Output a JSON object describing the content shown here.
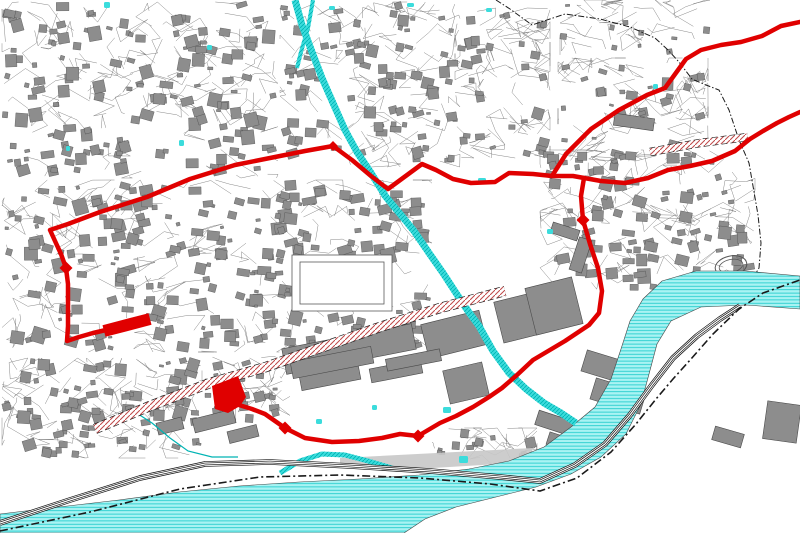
{
  "map": {
    "viewport": {
      "width": 800,
      "height": 533,
      "background": "#ffffff"
    },
    "colors": {
      "route_red": "#e00000",
      "water_fill": "#a9f3f3",
      "water_stripe": "#17c9c9",
      "stream_fill": "#3bdcdc",
      "stream_edge": "#00b4b4",
      "building_fill": "#8d8d8d",
      "building_stroke": "#4a4a4a",
      "parcel_line": "#737373",
      "railway_black": "#111111",
      "boundary_black": "#1a1a1a",
      "hatch_red": "#c04848",
      "station_gray": "#c8c8c8"
    },
    "route": {
      "width": 4.5,
      "main": [
        [
          800,
          22
        ],
        [
          781,
          26
        ],
        [
          762,
          36
        ],
        [
          741,
          42
        ],
        [
          721,
          45
        ],
        [
          701,
          50
        ],
        [
          686,
          59
        ],
        [
          665,
          88
        ],
        [
          647,
          95
        ],
        [
          619,
          110
        ],
        [
          591,
          129
        ],
        [
          566,
          154
        ],
        [
          552,
          176
        ],
        [
          533,
          174
        ],
        [
          509,
          173
        ],
        [
          495,
          182
        ],
        [
          471,
          183
        ],
        [
          453,
          179
        ],
        [
          436,
          170
        ],
        [
          422,
          164
        ],
        [
          388,
          189
        ],
        [
          371,
          176
        ],
        [
          352,
          160
        ],
        [
          333,
          146
        ],
        [
          305,
          151
        ],
        [
          275,
          157
        ],
        [
          235,
          165
        ],
        [
          190,
          179
        ],
        [
          147,
          197
        ],
        [
          100,
          212
        ],
        [
          68,
          224
        ],
        [
          50,
          230
        ],
        [
          55,
          241
        ],
        [
          61,
          254
        ],
        [
          66,
          268
        ],
        [
          68,
          284
        ],
        [
          68,
          306
        ],
        [
          68,
          326
        ],
        [
          67,
          341
        ],
        [
          79,
          337
        ],
        [
          93,
          333
        ],
        [
          106,
          330
        ]
      ],
      "branch_northeast": [
        [
          552,
          176
        ],
        [
          573,
          176
        ],
        [
          601,
          181
        ],
        [
          625,
          183
        ],
        [
          648,
          178
        ],
        [
          668,
          170
        ],
        [
          690,
          166
        ],
        [
          712,
          161
        ],
        [
          735,
          151
        ],
        [
          750,
          139
        ],
        [
          763,
          131
        ],
        [
          777,
          123
        ],
        [
          789,
          117
        ],
        [
          800,
          112
        ]
      ],
      "descent_south": [
        [
          584,
          178
        ],
        [
          581,
          196
        ],
        [
          583,
          220
        ],
        [
          590,
          244
        ],
        [
          598,
          268
        ],
        [
          602,
          291
        ],
        [
          599,
          313
        ],
        [
          589,
          325
        ],
        [
          565,
          341
        ],
        [
          533,
          360
        ],
        [
          517,
          375
        ],
        [
          502,
          388
        ],
        [
          489,
          397
        ],
        [
          473,
          407
        ],
        [
          456,
          416
        ],
        [
          440,
          423
        ],
        [
          418,
          436
        ],
        [
          400,
          434
        ],
        [
          382,
          438
        ],
        [
          359,
          441
        ],
        [
          332,
          442
        ],
        [
          305,
          438
        ],
        [
          285,
          428
        ],
        [
          275,
          421
        ],
        [
          265,
          414
        ],
        [
          252,
          409
        ],
        [
          239,
          405
        ]
      ],
      "junction_nodes": [
        [
          66,
          268
        ],
        [
          583,
          220
        ],
        [
          418,
          436
        ],
        [
          285,
          428
        ]
      ],
      "bend_node": [
        333,
        146
      ],
      "highlighted_building": [
        [
          212,
          386
        ],
        [
          238,
          376
        ],
        [
          246,
          397
        ],
        [
          240,
          406
        ],
        [
          228,
          413
        ],
        [
          215,
          409
        ]
      ],
      "highlighted_segment": {
        "points": [
          [
            104,
            331
          ],
          [
            150,
            319
          ]
        ],
        "width": 12
      }
    },
    "water": {
      "river": [
        [
          800,
          276
        ],
        [
          745,
          271
        ],
        [
          696,
          271
        ],
        [
          662,
          281
        ],
        [
          643,
          299
        ],
        [
          630,
          321
        ],
        [
          621,
          349
        ],
        [
          611,
          379
        ],
        [
          595,
          407
        ],
        [
          571,
          427
        ],
        [
          544,
          447
        ],
        [
          509,
          461
        ],
        [
          469,
          469
        ],
        [
          419,
          475
        ],
        [
          359,
          479
        ],
        [
          299,
          482
        ],
        [
          239,
          486
        ],
        [
          179,
          492
        ],
        [
          119,
          500
        ],
        [
          59,
          507
        ],
        [
          0,
          514
        ],
        [
          0,
          533
        ],
        [
          404,
          533
        ],
        [
          425,
          519
        ],
        [
          456,
          507
        ],
        [
          496,
          497
        ],
        [
          536,
          487
        ],
        [
          571,
          474
        ],
        [
          601,
          457
        ],
        [
          626,
          434
        ],
        [
          641,
          404
        ],
        [
          649,
          374
        ],
        [
          657,
          344
        ],
        [
          671,
          321
        ],
        [
          701,
          307
        ],
        [
          746,
          305
        ],
        [
          800,
          309
        ]
      ],
      "stream": [
        [
          295,
          0
        ],
        [
          302,
          25
        ],
        [
          312,
          52
        ],
        [
          322,
          78
        ],
        [
          333,
          103
        ],
        [
          345,
          130
        ],
        [
          357,
          152
        ],
        [
          371,
          173
        ],
        [
          386,
          197
        ],
        [
          401,
          215
        ],
        [
          414,
          231
        ],
        [
          429,
          253
        ],
        [
          443,
          273
        ],
        [
          456,
          293
        ],
        [
          468,
          311
        ],
        [
          479,
          326
        ],
        [
          493,
          351
        ],
        [
          509,
          373
        ],
        [
          526,
          389
        ],
        [
          544,
          403
        ],
        [
          561,
          413
        ],
        [
          576,
          423
        ]
      ],
      "stream_upper_branch": [
        [
          313,
          0
        ],
        [
          308,
          28
        ],
        [
          301,
          52
        ],
        [
          297,
          68
        ]
      ],
      "mill_channel_arc": [
        [
          280,
          473
        ],
        [
          300,
          461
        ],
        [
          322,
          454
        ],
        [
          345,
          455
        ],
        [
          368,
          461
        ],
        [
          392,
          468
        ]
      ],
      "minor_channel": [
        [
          132,
          410
        ],
        [
          152,
          423
        ],
        [
          170,
          438
        ],
        [
          188,
          451
        ],
        [
          212,
          457
        ],
        [
          238,
          457
        ]
      ],
      "ponds": [
        [
          104,
          2,
          6,
          6
        ],
        [
          207,
          45,
          5,
          5
        ],
        [
          179,
          140,
          5,
          6
        ],
        [
          66,
          146,
          4,
          5
        ],
        [
          329,
          6,
          6,
          4
        ],
        [
          407,
          3,
          7,
          4
        ],
        [
          486,
          8,
          6,
          4
        ],
        [
          478,
          178,
          8,
          5
        ],
        [
          547,
          229,
          6,
          5
        ],
        [
          443,
          407,
          8,
          6
        ],
        [
          459,
          456,
          9,
          7
        ],
        [
          372,
          405,
          5,
          5
        ],
        [
          316,
          419,
          6,
          5
        ],
        [
          653,
          84,
          5,
          5
        ]
      ]
    },
    "railway": {
      "path": [
        [
          0,
          523
        ],
        [
          70,
          500
        ],
        [
          140,
          478
        ],
        [
          205,
          464
        ],
        [
          270,
          462
        ],
        [
          350,
          466
        ],
        [
          430,
          471
        ],
        [
          500,
          477
        ],
        [
          540,
          481
        ],
        [
          575,
          465
        ],
        [
          605,
          444
        ],
        [
          630,
          415
        ],
        [
          652,
          385
        ],
        [
          673,
          358
        ],
        [
          697,
          336
        ],
        [
          720,
          319
        ],
        [
          740,
          306
        ]
      ]
    },
    "boundaries": {
      "river_dashdot": [
        [
          0,
          531
        ],
        [
          90,
          512
        ],
        [
          180,
          489
        ],
        [
          260,
          477
        ],
        [
          340,
          475
        ],
        [
          420,
          478
        ],
        [
          490,
          484
        ],
        [
          540,
          491
        ],
        [
          577,
          478
        ],
        [
          611,
          452
        ],
        [
          636,
          424
        ],
        [
          656,
          399
        ],
        [
          673,
          379
        ],
        [
          691,
          359
        ],
        [
          713,
          334
        ],
        [
          739,
          309
        ],
        [
          763,
          293
        ],
        [
          800,
          280
        ]
      ],
      "northeast_dashdot": [
        [
          496,
          0
        ],
        [
          510,
          9
        ],
        [
          532,
          25
        ],
        [
          565,
          14
        ],
        [
          600,
          19
        ],
        [
          630,
          27
        ],
        [
          655,
          38
        ],
        [
          668,
          50
        ],
        [
          679,
          62
        ],
        [
          692,
          79
        ],
        [
          706,
          85
        ],
        [
          719,
          90
        ],
        [
          729,
          110
        ],
        [
          739,
          140
        ],
        [
          749,
          163
        ],
        [
          753,
          186
        ],
        [
          758,
          215
        ],
        [
          761,
          243
        ],
        [
          759,
          268
        ],
        [
          756,
          273
        ]
      ]
    },
    "hatched_bands": [
      {
        "points": [
          [
            95,
            429
          ],
          [
            150,
            406
          ],
          [
            210,
            383
          ],
          [
            266,
            367
          ],
          [
            320,
            348
          ],
          [
            380,
            327
          ],
          [
            440,
            308
          ],
          [
            505,
            291
          ]
        ],
        "width": 9
      },
      {
        "points": [
          [
            650,
            152
          ],
          [
            700,
            143
          ],
          [
            748,
            137
          ]
        ],
        "width": 7
      }
    ],
    "large_buildings": [
      [
        283,
        336,
        132,
        26,
        -11
      ],
      [
        300,
        370,
        60,
        15,
        -11
      ],
      [
        370,
        364,
        52,
        14,
        -11
      ],
      [
        424,
        317,
        60,
        35,
        -14
      ],
      [
        498,
        295,
        55,
        42,
        -14
      ],
      [
        530,
        282,
        48,
        48,
        -14
      ],
      [
        583,
        357,
        52,
        22,
        17
      ],
      [
        592,
        385,
        52,
        22,
        17
      ],
      [
        765,
        403,
        34,
        38,
        8
      ],
      [
        536,
        416,
        40,
        15,
        18
      ],
      [
        547,
        438,
        42,
        13,
        18
      ],
      [
        446,
        366,
        40,
        34,
        -13
      ],
      [
        291,
        354,
        82,
        17,
        -11
      ],
      [
        386,
        354,
        55,
        12,
        -11
      ],
      [
        193,
        414,
        42,
        14,
        -14
      ],
      [
        228,
        428,
        30,
        12,
        -14
      ],
      [
        614,
        116,
        40,
        12,
        8
      ],
      [
        574,
        238,
        13,
        34,
        18
      ],
      [
        551,
        226,
        28,
        11,
        18
      ],
      [
        713,
        430,
        30,
        14,
        16
      ],
      [
        157,
        420,
        26,
        12,
        -14
      ]
    ],
    "station_platform": [
      [
        340,
        458
      ],
      [
        532,
        448
      ],
      [
        532,
        462
      ],
      [
        400,
        470
      ],
      [
        340,
        466
      ]
    ],
    "courtyards": [
      [
        292,
        255,
        100,
        56
      ],
      [
        300,
        262,
        84,
        42
      ]
    ],
    "stadium": {
      "cx": 731,
      "cy": 266,
      "rx": 16,
      "ry": 10,
      "rot": -12
    },
    "urban_regions": [
      {
        "x": 2,
        "y": 2,
        "w": 276,
        "h": 176,
        "buildings": 150,
        "min": 4,
        "max": 13,
        "lines": 90,
        "seed": 11
      },
      {
        "x": 280,
        "y": 2,
        "w": 180,
        "h": 165,
        "buildings": 85,
        "min": 4,
        "max": 12,
        "lines": 70,
        "seed": 22
      },
      {
        "x": 455,
        "y": 8,
        "w": 95,
        "h": 150,
        "buildings": 32,
        "min": 4,
        "max": 11,
        "lines": 48,
        "seed": 33
      },
      {
        "x": 558,
        "y": 58,
        "w": 150,
        "h": 118,
        "buildings": 30,
        "min": 4,
        "max": 12,
        "lines": 55,
        "seed": 44
      },
      {
        "x": 2,
        "y": 180,
        "w": 430,
        "h": 172,
        "buildings": 265,
        "min": 3,
        "max": 14,
        "lines": 120,
        "seed": 55
      },
      {
        "x": 540,
        "y": 150,
        "w": 215,
        "h": 142,
        "buildings": 95,
        "min": 4,
        "max": 13,
        "lines": 70,
        "seed": 66
      },
      {
        "x": 2,
        "y": 358,
        "w": 200,
        "h": 100,
        "buildings": 78,
        "min": 4,
        "max": 13,
        "lines": 60,
        "seed": 77
      },
      {
        "x": 204,
        "y": 356,
        "w": 86,
        "h": 68,
        "buildings": 22,
        "min": 4,
        "max": 11,
        "lines": 22,
        "seed": 88
      },
      {
        "x": 432,
        "y": 428,
        "w": 105,
        "h": 38,
        "buildings": 14,
        "min": 4,
        "max": 10,
        "lines": 14,
        "seed": 99
      },
      {
        "x": 560,
        "y": 0,
        "w": 150,
        "h": 55,
        "buildings": 10,
        "min": 3,
        "max": 9,
        "lines": 25,
        "seed": 12
      }
    ]
  }
}
